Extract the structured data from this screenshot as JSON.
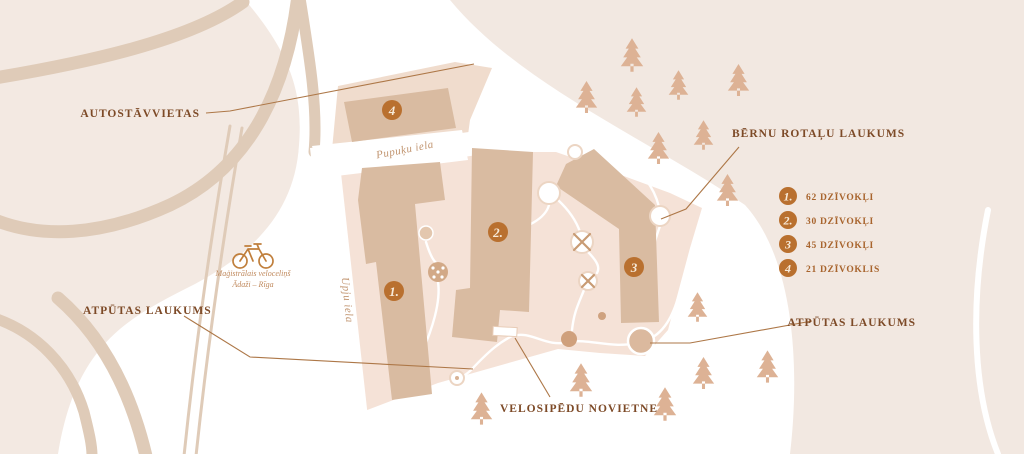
{
  "labels": {
    "parking": "AUTOSTĀVVIETAS",
    "playground": "BĒRNU ROTAĻU LAUKUMS",
    "rest_left": "ATPŪTAS LAUKUMS",
    "rest_right": "ATPŪTAS LAUKUMS",
    "bike_storage": "VELOSIPĒDU NOVIETNE"
  },
  "map": {
    "streets": [
      {
        "name": "Pupuķu iela"
      },
      {
        "name": "Upju iela"
      }
    ],
    "buildings": [
      {
        "number": "1."
      },
      {
        "number": "2."
      },
      {
        "number": "3"
      },
      {
        "number": "4"
      }
    ]
  },
  "bike_path": {
    "caption_line1": "Maģistrālais veloceliņš",
    "caption_line2": "Ādaži – Rīga"
  },
  "legend": {
    "items": [
      {
        "number": "1.",
        "text": "62 DZĪVOKĻI"
      },
      {
        "number": "2.",
        "text": "30 DZĪVOKĻI"
      },
      {
        "number": "3",
        "text": "45 DZĪVOKĻI"
      },
      {
        "number": "4",
        "text": "21 DZĪVOKLIS"
      }
    ]
  },
  "colors": {
    "blob": "#f3e9e2",
    "rightband": "#f2e8e1",
    "road": "#dfcbb8",
    "site": "#f5e2d7",
    "pad": "#f0dccd",
    "building": "#d9bba1",
    "tree": "#ddb295",
    "marker": "#b9702f",
    "label": "#7d4a27",
    "legendtext": "#a8642d",
    "leader": "#ad7747",
    "street": "#c1946f",
    "caption": "#c08a5e",
    "bike": "#c07f3c"
  }
}
